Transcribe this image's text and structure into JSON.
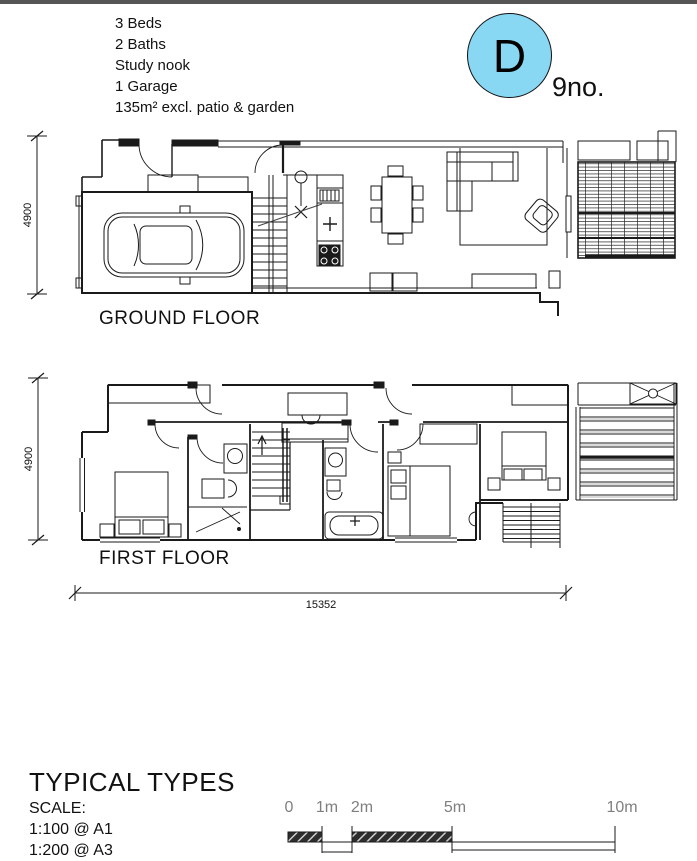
{
  "page": {
    "top_border_color": "#555555",
    "background": "#ffffff",
    "line_color": "#1a1a1a"
  },
  "header": {
    "specs": [
      "3 Beds",
      "2 Baths",
      "Study nook",
      "1 Garage",
      "135m² excl. patio & garden"
    ],
    "badge": {
      "letter": "D",
      "count": "9no.",
      "fill": "#88d7f3"
    }
  },
  "plans": {
    "ground": {
      "label": "GROUND FLOOR",
      "side_dimension": "4900"
    },
    "first": {
      "label": "FIRST FLOOR",
      "side_dimension": "4900"
    },
    "bottom_dimension": "15352"
  },
  "footer": {
    "title": "TYPICAL TYPES",
    "scale_heading": "SCALE:",
    "scale_lines": [
      "1:100 @ A1",
      "1:200 @ A3"
    ],
    "scalebar": {
      "labels": [
        "0",
        "1m",
        "2m",
        "5m",
        "10m"
      ],
      "label_color": "#7f7f7f"
    }
  }
}
